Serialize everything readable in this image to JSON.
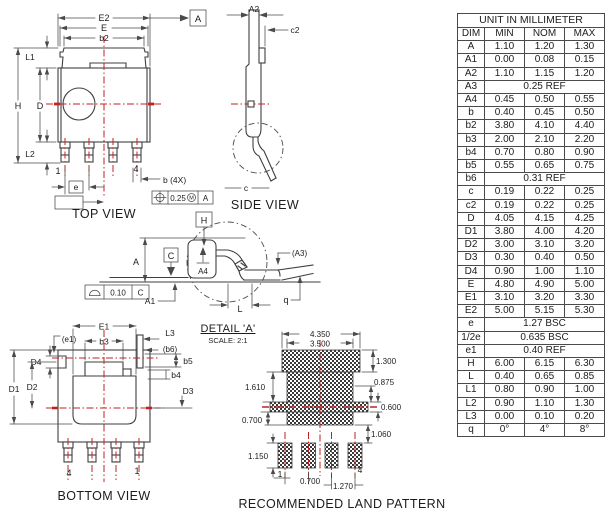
{
  "table": {
    "title": "UNIT IN MILLIMETER",
    "headers": [
      "DIM",
      "MIN",
      "NOM",
      "MAX"
    ],
    "rows": [
      {
        "dim": "A",
        "min": "1.10",
        "nom": "1.20",
        "max": "1.30"
      },
      {
        "dim": "A1",
        "min": "0.00",
        "nom": "0.08",
        "max": "0.15"
      },
      {
        "dim": "A2",
        "min": "1.10",
        "nom": "1.15",
        "max": "1.20"
      },
      {
        "dim": "A3",
        "span": "0.25 REF"
      },
      {
        "dim": "A4",
        "min": "0.45",
        "nom": "0.50",
        "max": "0.55"
      },
      {
        "dim": "b",
        "min": "0.40",
        "nom": "0.45",
        "max": "0.50"
      },
      {
        "dim": "b2",
        "min": "3.80",
        "nom": "4.10",
        "max": "4.40"
      },
      {
        "dim": "b3",
        "min": "2.00",
        "nom": "2.10",
        "max": "2.20"
      },
      {
        "dim": "b4",
        "min": "0.70",
        "nom": "0.80",
        "max": "0.90"
      },
      {
        "dim": "b5",
        "min": "0.55",
        "nom": "0.65",
        "max": "0.75"
      },
      {
        "dim": "b6",
        "span": "0.31 REF"
      },
      {
        "dim": "c",
        "min": "0.19",
        "nom": "0.22",
        "max": "0.25"
      },
      {
        "dim": "c2",
        "min": "0.19",
        "nom": "0.22",
        "max": "0.25"
      },
      {
        "dim": "D",
        "min": "4.05",
        "nom": "4.15",
        "max": "4.25"
      },
      {
        "dim": "D1",
        "min": "3.80",
        "nom": "4.00",
        "max": "4.20"
      },
      {
        "dim": "D2",
        "min": "3.00",
        "nom": "3.10",
        "max": "3.20"
      },
      {
        "dim": "D3",
        "min": "0.30",
        "nom": "0.40",
        "max": "0.50"
      },
      {
        "dim": "D4",
        "min": "0.90",
        "nom": "1.00",
        "max": "1.10"
      },
      {
        "dim": "E",
        "min": "4.80",
        "nom": "4.90",
        "max": "5.00"
      },
      {
        "dim": "E1",
        "min": "3.10",
        "nom": "3.20",
        "max": "3.30"
      },
      {
        "dim": "E2",
        "min": "5.00",
        "nom": "5.15",
        "max": "5.30"
      },
      {
        "dim": "e",
        "span": "1.27 BSC"
      },
      {
        "dim": "1/2e",
        "span": "0.635 BSC"
      },
      {
        "dim": "e1",
        "span": "0.40 REF"
      },
      {
        "dim": "H",
        "min": "6.00",
        "nom": "6.15",
        "max": "6.30"
      },
      {
        "dim": "L",
        "min": "0.40",
        "nom": "0.65",
        "max": "0.85"
      },
      {
        "dim": "L1",
        "min": "0.80",
        "nom": "0.90",
        "max": "1.00"
      },
      {
        "dim": "L2",
        "min": "0.90",
        "nom": "1.10",
        "max": "1.30"
      },
      {
        "dim": "L3",
        "min": "0.00",
        "nom": "0.10",
        "max": "0.20"
      },
      {
        "dim": "q",
        "min": "0°",
        "nom": "4°",
        "max": "8°"
      }
    ]
  },
  "top_view": {
    "caption": "TOP VIEW",
    "labels": {
      "e2": "E2",
      "e": "E",
      "b2": "b2",
      "h": "H",
      "d": "D",
      "l1": "L1",
      "l2": "L2",
      "pin1": "1",
      "pin4": "4",
      "pitch": "e",
      "half_pitch": "1/2e",
      "lead_width": "b (4X)",
      "datum_a": "A"
    },
    "tolerance": {
      "value": "0.25",
      "modifier": "M",
      "datum": "A"
    }
  },
  "side_view": {
    "caption": "SIDE VIEW",
    "labels": {
      "a2": "A2",
      "c2": "c2",
      "c": "c"
    }
  },
  "profile_view": {
    "labels": {
      "a": "A",
      "a1": "A1",
      "a3": "(A3)",
      "a4": "A4",
      "l": "L",
      "q": "q"
    },
    "datums": {
      "h": "H",
      "c": "C"
    },
    "flatness": {
      "value": "0.10",
      "datum": "C"
    }
  },
  "bottom_view": {
    "caption": "BOTTOM VIEW",
    "labels": {
      "e1": "E1",
      "b3": "b3",
      "e1_ref": "(e1)",
      "d4": "D4",
      "d2": "D2",
      "d1": "D1",
      "l3": "L3",
      "b6_ref": "(b6)",
      "b5": "b5",
      "b4": "b4",
      "d3": "D3",
      "pin1": "1",
      "pin4": "4"
    }
  },
  "detail_a": {
    "title": "DETAIL 'A'",
    "scale": "SCALE: 2:1"
  },
  "land_pattern": {
    "caption": "RECOMMENDED LAND PATTERN",
    "dims": {
      "outer_width": "4.350",
      "inner_width": "3.500",
      "tab_height": "1.300",
      "mid_height": "0.875",
      "bar_height": "0.600",
      "gap": "1.060",
      "left_upper": "1.610",
      "left_lower": "0.700",
      "pad_height": "1.150",
      "pad_gap": "0.700",
      "pitch": "1.270"
    },
    "pins": {
      "pin1": "1",
      "pin4": "4"
    }
  },
  "colors": {
    "line": "#3f3f3f",
    "centerline": "#c32222",
    "text": "#1c1c1c",
    "background": "#ffffff"
  }
}
